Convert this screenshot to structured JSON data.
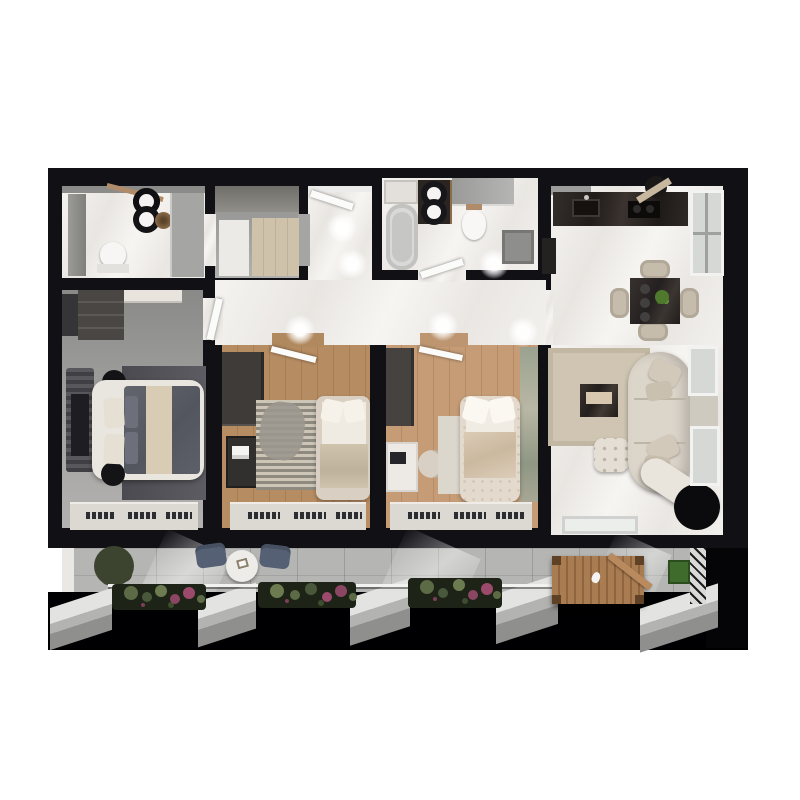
{
  "scene": {
    "type": "3d-floor-plan-render",
    "view": "top-down",
    "background": "#ffffff",
    "description": "Photorealistic top-down 3D render of a three-bedroom apartment with two bathrooms, walk-in closet, open kitchen-living area and a long balcony with planters"
  },
  "palette": {
    "wall": "#101015",
    "marbleLight": "#f2f0ed",
    "closetFloor": "#9d9d9b",
    "graniteBalcony": "#b5b5b3",
    "counterDark": "#2b2522",
    "tableDark": "#2e2a27",
    "blackFixture": "#141417",
    "tub": "#d9d9d7",
    "glassGray": "#a5a5a3",
    "duvet": "#5d6068",
    "runner": "#d9ccb4",
    "rugDark": "#53535a",
    "rugBeige": "#cfc5b2",
    "rugCream": "#dcd7cd",
    "bedFrame": "#e9e5df",
    "bedFrame2": "#d9d0c3",
    "bedFrame3": "#e3dacd",
    "darkUnit": "#434040",
    "deskDark": "#31302f",
    "deskWhite": "#edeae5",
    "chairBeige": "#c9bfae",
    "sofa": "#dcd5ca",
    "pouf": "#e4ded4",
    "sideTableBlack": "#0b0b0d",
    "benchWood": "#a97c52",
    "slabConcrete": "#c6c6c4",
    "accentWall": "#9aa28f",
    "planterLeaf": "#5c6b45",
    "planterFlower": "#8a4663",
    "treeGreen": "#3c4430",
    "outdoorChair": "#566074",
    "white": "#f6f5f2"
  },
  "rooms": [
    {
      "name": "bathroom-1",
      "position": "top-left",
      "furniture": [
        "double-vessel-sink",
        "toilet",
        "tall-cabinet",
        "shower-glass",
        "rattan-pendant",
        "wood-shelf"
      ]
    },
    {
      "name": "walk-in-closet",
      "position": "top-left-center",
      "furniture": [
        "beige-wardrobe",
        "white-rug"
      ]
    },
    {
      "name": "hallway",
      "position": "center",
      "furniture": [
        "entry-door",
        "ceiling-spotlights"
      ]
    },
    {
      "name": "bathroom-2",
      "position": "top-center",
      "furniture": [
        "bathtub",
        "double-vessel-sink",
        "wall-hung-toilet",
        "shower-tray",
        "laundry-counter"
      ]
    },
    {
      "name": "kitchen-dining",
      "position": "top-right",
      "furniture": [
        "stone-counter",
        "sink",
        "cooktop",
        "range-hood",
        "tall-black-cabinet",
        "dining-table",
        "four-chairs",
        "table-plant"
      ]
    },
    {
      "name": "master-bedroom",
      "position": "left",
      "furniture": [
        "double-bed",
        "striped-headboard-bench",
        "wardrobe",
        "dresser",
        "round-nightstand-x2",
        "dark-rug",
        "window-radiators"
      ]
    },
    {
      "name": "bedroom-2",
      "position": "center-left",
      "furniture": [
        "bed",
        "wardrobe",
        "desk",
        "chair",
        "striped-rug",
        "window-radiators"
      ]
    },
    {
      "name": "bedroom-3",
      "position": "center-right",
      "furniture": [
        "tufted-bed",
        "wardrobe",
        "white-desk",
        "chair",
        "cream-rug",
        "accent-wall",
        "window-radiators"
      ]
    },
    {
      "name": "living-room",
      "position": "right",
      "furniture": [
        "curved-sofa",
        "chaise",
        "coffee-table",
        "tufted-ottoman",
        "black-side-table",
        "beige-rug",
        "balcony-door"
      ]
    },
    {
      "name": "balcony",
      "position": "bottom",
      "furniture": [
        "potted-tree",
        "two-outdoor-chairs",
        "round-table",
        "flower-planter-x3",
        "wooden-bench-swing",
        "green-planter-box",
        "railing",
        "concrete-dividers"
      ]
    }
  ]
}
